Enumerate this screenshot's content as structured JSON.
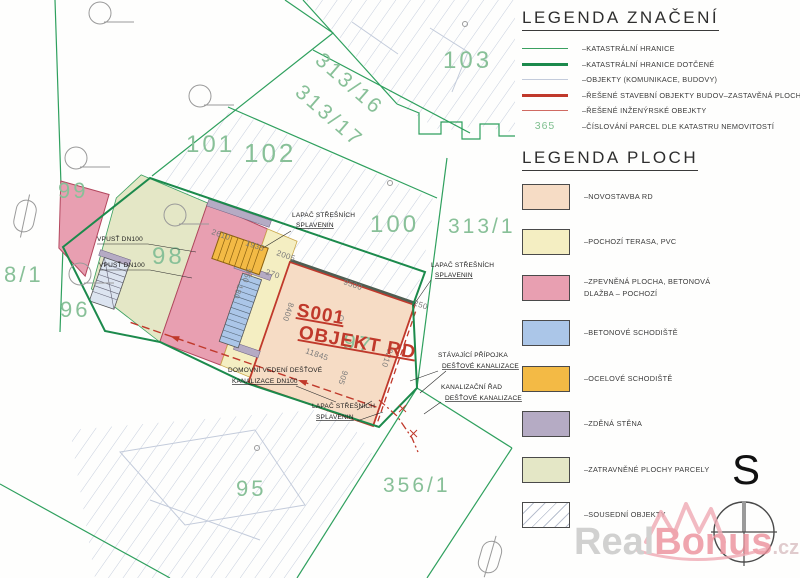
{
  "legend_symbols": {
    "title": "LEGENDA ZNAČENÍ",
    "items": [
      {
        "type": "line",
        "color": "#3aa060",
        "weight": 1,
        "label": "–KATASTRÁLNÍ HRANICE"
      },
      {
        "type": "line",
        "color": "#1c8a4c",
        "weight": 2.5,
        "label": "–KATASTRÁLNÍ HRANICE DOTČENÉ"
      },
      {
        "type": "line",
        "color": "#c3cbdb",
        "weight": 1.2,
        "label": "–OBJEKTY (KOMUNIKACE, BUDOVY)"
      },
      {
        "type": "line",
        "color": "#c0392b",
        "weight": 2.5,
        "label": "–ŘEŠENÉ STAVEBNÍ OBJEKTY BUDOV–ZASTAVĚNÁ PLOCHA"
      },
      {
        "type": "line",
        "color": "#d06a62",
        "weight": 1,
        "label": "–ŘEŠENÉ INŽENÝRSKÉ OBEJKTY"
      },
      {
        "type": "number",
        "sample": "365",
        "color": "#7fbf8f",
        "label": "–ČÍSLOVÁNÍ PARCEL DLE KATASTRU NEMOVITOSTÍ"
      }
    ]
  },
  "legend_areas": {
    "title": "LEGENDA PLOCH",
    "items": [
      {
        "color": "#f6dcc5",
        "hatch": false,
        "label": [
          "–NOVOSTAVBA RD"
        ]
      },
      {
        "color": "#f4eec2",
        "hatch": false,
        "label": [
          "–POCHOZÍ TERASA, PVC"
        ]
      },
      {
        "color": "#e89fb1",
        "hatch": false,
        "label": [
          "–ZPEVNĚNÁ PLOCHA, BETONOVÁ",
          "DLAŽBA – POCHOZÍ"
        ]
      },
      {
        "color": "#abc6e8",
        "hatch": false,
        "label": [
          "–BETONOVÉ SCHODIŠTĚ"
        ]
      },
      {
        "color": "#f3ba45",
        "hatch": false,
        "label": [
          "–OCELOVÉ SCHODIŠTĚ"
        ]
      },
      {
        "color": "#b5abc4",
        "hatch": false,
        "label": [
          "–ZDĚNÁ STĚNA"
        ]
      },
      {
        "color": "#e4e7c6",
        "hatch": false,
        "label": [
          "–ZATRAVNĚNÉ PLOCHY PARCELY"
        ]
      },
      {
        "color": "#ffffff",
        "hatch": true,
        "label": [
          "–SOUSEDNÍ OBJEKTY"
        ]
      }
    ]
  },
  "map": {
    "building_label": {
      "code": "S001",
      "name": "OBJEKT RD",
      "color": "#c0392b"
    },
    "parcel_color": "#88c098",
    "parcels": [
      {
        "t": "102",
        "x": 244,
        "y": 162,
        "s": 26,
        "r": 0
      },
      {
        "t": "101",
        "x": 186,
        "y": 152,
        "s": 24,
        "r": 0
      },
      {
        "t": "103",
        "x": 443,
        "y": 68,
        "s": 24,
        "r": 0
      },
      {
        "t": "99",
        "x": 58,
        "y": 198,
        "s": 22,
        "r": 0
      },
      {
        "t": "98",
        "x": 152,
        "y": 264,
        "s": 24,
        "r": 0
      },
      {
        "t": "96",
        "x": 60,
        "y": 317,
        "s": 22,
        "r": 0
      },
      {
        "t": "8/1",
        "x": 4,
        "y": 282,
        "s": 22,
        "r": 0
      },
      {
        "t": "100",
        "x": 370,
        "y": 232,
        "s": 24,
        "r": 0
      },
      {
        "t": "313/1",
        "x": 448,
        "y": 233,
        "s": 21,
        "r": 0
      },
      {
        "t": "97",
        "x": 342,
        "y": 348,
        "s": 22,
        "r": 10
      },
      {
        "t": "95",
        "x": 236,
        "y": 496,
        "s": 22,
        "r": 0
      },
      {
        "t": "356/1",
        "x": 383,
        "y": 492,
        "s": 21,
        "r": 0
      },
      {
        "t": "313/16",
        "x": 314,
        "y": 62,
        "s": 21,
        "r": 41
      },
      {
        "t": "313/17",
        "x": 294,
        "y": 94,
        "s": 21,
        "r": 41
      }
    ],
    "dimensions": [
      {
        "t": "2610",
        "x": 211,
        "y": 234,
        "r": 19
      },
      {
        "t": "1935",
        "x": 245,
        "y": 245,
        "r": 19
      },
      {
        "t": "2005",
        "x": 276,
        "y": 255,
        "r": 19
      },
      {
        "t": "270",
        "x": 265,
        "y": 274,
        "r": 19
      },
      {
        "t": "950",
        "x": 247,
        "y": 268,
        "r": 109
      },
      {
        "t": "180",
        "x": 238,
        "y": 284,
        "r": 109
      },
      {
        "t": "9500",
        "x": 343,
        "y": 284,
        "r": 19
      },
      {
        "t": "8400",
        "x": 289,
        "y": 302,
        "r": 109
      },
      {
        "t": "11845",
        "x": 305,
        "y": 353,
        "r": 19
      },
      {
        "t": "9210",
        "x": 388,
        "y": 348,
        "r": 109
      },
      {
        "t": "905",
        "x": 343,
        "y": 370,
        "r": 109
      },
      {
        "t": "250",
        "x": 413,
        "y": 305,
        "r": 19
      }
    ],
    "annotations": [
      {
        "lines": [
          "VPUSŤ DN100"
        ],
        "x": 97,
        "y": 241,
        "lh": 10,
        "u": false,
        "leaders": [
          [
            [
              97,
              244
            ],
            [
              148,
              244
            ],
            [
              196,
              252
            ]
          ]
        ]
      },
      {
        "lines": [
          "VPUSŤ DN100"
        ],
        "x": 99,
        "y": 267,
        "lh": 10,
        "u": false,
        "leaders": [
          [
            [
              99,
              270
            ],
            [
              150,
              270
            ],
            [
              192,
              278
            ]
          ]
        ]
      },
      {
        "lines": [
          "LAPAČ STŘEŠNÍCH",
          "SPLAVENIN"
        ],
        "x": 292,
        "y": 217,
        "lh": 10,
        "u": true,
        "leaders": [
          [
            [
              291,
              231
            ],
            [
              263,
              248
            ]
          ]
        ]
      },
      {
        "lines": [
          "LAPAČ STŘEŠNÍCH",
          "SPLAVENIN"
        ],
        "x": 431,
        "y": 267,
        "lh": 10,
        "u": true,
        "leaders": [
          [
            [
              431,
              280
            ],
            [
              413,
              306
            ]
          ]
        ]
      },
      {
        "lines": [
          "STÁVAJÍCÍ PŘÍPOJKA",
          "DEŠŤOVÉ KANALIZACE"
        ],
        "x": 438,
        "y": 357,
        "lh": 11,
        "u": true,
        "leaders": [
          [
            [
              438,
              371
            ],
            [
              410,
              381
            ]
          ],
          [
            [
              446,
              371
            ],
            [
              420,
              393
            ]
          ]
        ]
      },
      {
        "lines": [
          "KANALIZAČNÍ ŘAD",
          "DEŠŤOVÉ KANALIZACE"
        ],
        "x": 441,
        "y": 389,
        "lh": 11,
        "u": true,
        "leaders": [
          [
            [
              441,
              402
            ],
            [
              424,
              414
            ]
          ]
        ]
      },
      {
        "lines": [
          "DOMOVNÍ VEDENÍ DEŠŤOVÉ",
          "KANALIZACE DN100"
        ],
        "x": 228,
        "y": 372,
        "lh": 11,
        "u": true,
        "leaders": [
          [
            [
              296,
              386
            ],
            [
              336,
              402
            ]
          ]
        ]
      },
      {
        "lines": [
          "LAPAČ STŘEŠNÍCH",
          "SPLAVENIN"
        ],
        "x": 312,
        "y": 408,
        "lh": 11,
        "u": true,
        "leaders": [
          [
            [
              357,
              410
            ],
            [
              372,
              401
            ]
          ],
          [
            [
              357,
              421
            ],
            [
              383,
              412
            ]
          ]
        ]
      }
    ]
  },
  "compass": {
    "label": "S"
  },
  "watermark": {
    "real": "Real",
    "bonus": "Bonus",
    "tld": ".cz"
  },
  "colors": {
    "cadastral_line": "#2fa05e",
    "cadastral_line_affected": "#1c8a4c",
    "objects_line": "#c3cbdb",
    "solved_building": "#c0392b",
    "dimension_text": "#7a7a7a"
  }
}
